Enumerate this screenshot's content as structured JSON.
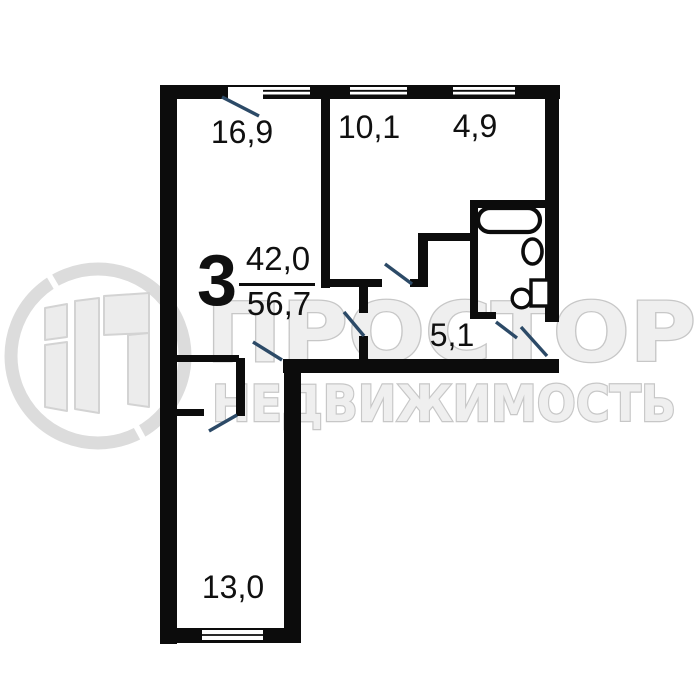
{
  "apartment": {
    "rooms_count": "3",
    "living_area": "42,0",
    "total_area": "56,7"
  },
  "room_labels": [
    {
      "id": "room-top-left",
      "area": "16,9"
    },
    {
      "id": "room-top-middle",
      "area": "10,1"
    },
    {
      "id": "kitchen",
      "area": "4,9"
    },
    {
      "id": "hallway",
      "area": "5,1"
    },
    {
      "id": "room-bottom",
      "area": "13,0"
    }
  ],
  "watermark": {
    "brand": "ПРОСТОР",
    "subtitle": "НЕДВИЖИМОСТЬ"
  },
  "colors": {
    "wall": "#0c0c0c",
    "door_swing": "#2c4a67",
    "watermark_fill": "#efefef",
    "watermark_outline": "#c7c7c7",
    "label_text": "#101010"
  }
}
